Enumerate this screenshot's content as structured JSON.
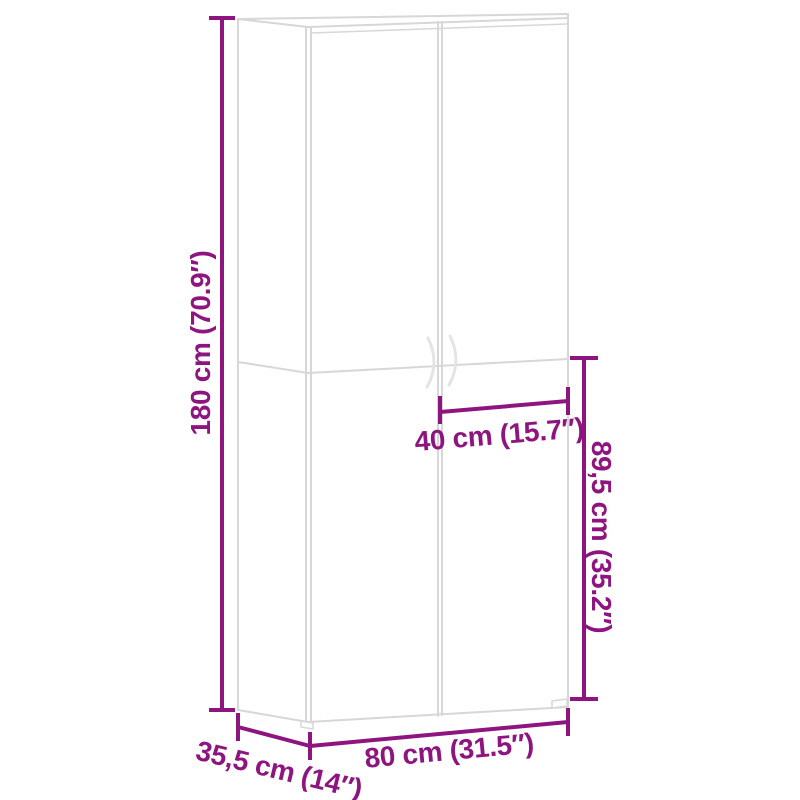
{
  "colors": {
    "accent": "#8E1480",
    "cabinet_line": "#D7D7D7",
    "handle_line": "#E4E4E4"
  },
  "diagram": {
    "kind": "furniture-dimension-diagram",
    "subject": "two-door tall cabinet line drawing",
    "labels": {
      "height": "180 cm (70.9″)",
      "door_width": "40 cm (15.7″)",
      "lower_section_height": "89,5 cm (35.2″)",
      "width": "80 cm (31.5″)",
      "depth": "35,5 cm (14″)"
    }
  }
}
